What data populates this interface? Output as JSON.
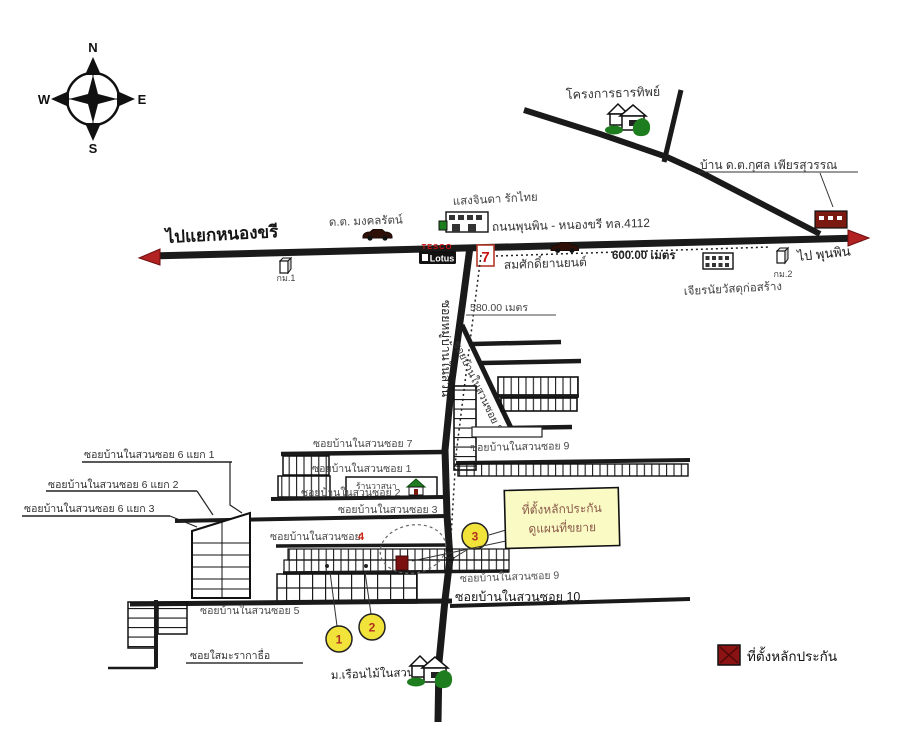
{
  "compass": {
    "n": "N",
    "e": "E",
    "s": "S",
    "w": "W"
  },
  "highway": {
    "to_left": "ไปแยกหนองขรี",
    "name": "ถนนพุนพิน - หนองขรี ทล.4112",
    "to_right": "ไป พุนพิน",
    "km1": "กม.1",
    "km2": "กม.2",
    "distance": "600.00 เมตร"
  },
  "landmarks": {
    "project": "โครงการธารทิพย์",
    "police_house": "บ้าน ด.ต.กุศล เพียรสุวรรณ",
    "mongkol": "ด.ต. มงคลรัตน์",
    "saengjinda": "แสงจินดา รักไทย",
    "tesco": "TESCO",
    "lotus": "Lotus",
    "seven": "7",
    "garage": "สมศักดิ์ยานยนต์",
    "materials_shop": "เจียรนัยวัสดุก่อสร้าง",
    "wasana_shop": "ร้านวาสนา",
    "village": "ม.เรือนไม้ในสวน"
  },
  "soi_main": {
    "vertical_name": "ซอยหมู่บ้านในสวน",
    "distance": "580.00 เมตร",
    "soi8": "ซอยบ้านในสวนซอย 8"
  },
  "sois": {
    "soi6_1": "ซอยบ้านในสวนซอย 6 แยก 1",
    "soi6_2": "ซอยบ้านในสวนซอย 6 แยก 2",
    "soi6_3": "ซอยบ้านในสวนซอย 6 แยก 3",
    "soi7": "ซอยบ้านในสวนซอย 7",
    "soi1": "ซอยบ้านในสวนซอย 1",
    "soi2": "ซอยบ้านในสวนซอย 2",
    "soi3": "ซอยบ้านในสวนซอย 3",
    "soi4_text": "ซอยบ้านในสวนซอย",
    "soi4_num": "4",
    "soi5": "ซอยบ้านในสวนซอย 5",
    "soi9_upper": "ซอยบ้านในสวนซอย 9",
    "soi9_lower": "ซอยบ้านในสวนซอย 9",
    "soi10": "ซอยบ้านในสวนซอย 10",
    "saimaka": "ซอยใสมะรากาธื่อ"
  },
  "callout": {
    "line1": "ที่ตั้งหลักประกัน",
    "line2": "ดูแผนที่ขยาย"
  },
  "markers": {
    "m1": "1",
    "m2": "2",
    "m3": "3"
  },
  "legend": {
    "label": "ที่ตั้งหลักประกัน"
  },
  "colors": {
    "road": "#1a1a1a",
    "arrow_red": "#b22222",
    "marker_red": "#7a1010",
    "legend_red": "#8b1313",
    "circle_yellow": "#f2e33a",
    "callout_bg": "#fafac4",
    "green": "#1e7d1e"
  }
}
